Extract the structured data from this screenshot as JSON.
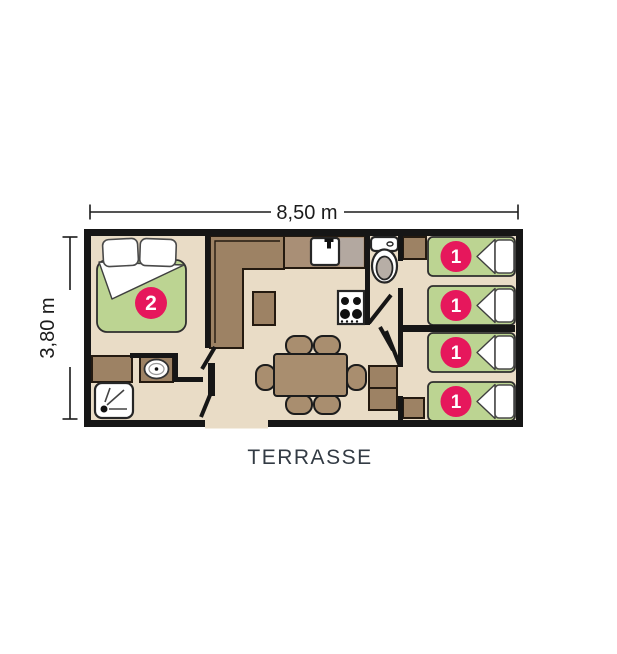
{
  "labels": {
    "width_dimension": "8,50 m",
    "height_dimension": "3,80 m",
    "terrace": "TERRASSE"
  },
  "beds": {
    "master_badge": "2",
    "singles": [
      {
        "badge": "1"
      },
      {
        "badge": "1"
      },
      {
        "badge": "1"
      },
      {
        "badge": "1"
      }
    ]
  },
  "colors": {
    "floor": "#e9dcc6",
    "wall": "#161616",
    "furniture_brown": "#9d8264",
    "furniture_brown_light": "#a98f76",
    "table_brown": "#a98e6f",
    "drainer_gray": "#b3a8a0",
    "mattress_green": "#bcd492",
    "badge_pink": "#e6175c",
    "fixture_white": "#ffffff",
    "seat_gray": "#b7aea6",
    "terrace_text": "#333b44",
    "dimension_text": "#1b1b1b"
  }
}
